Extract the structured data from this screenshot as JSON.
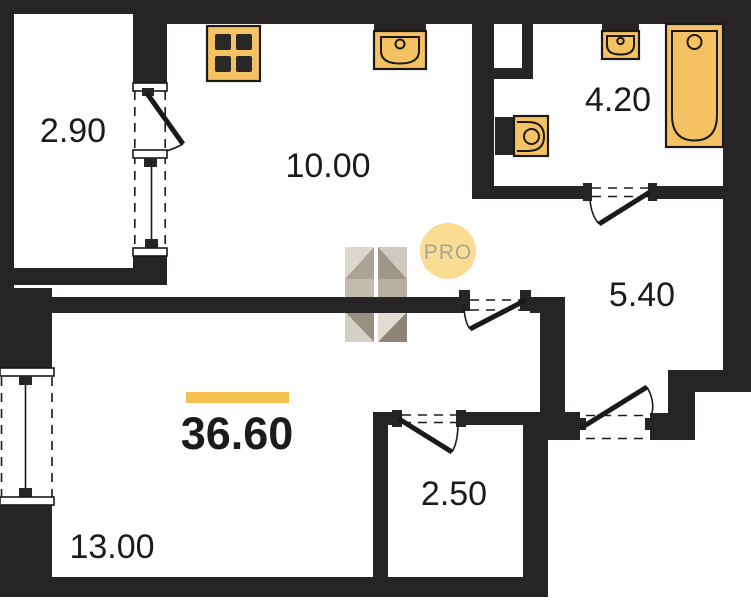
{
  "floor_plan": {
    "type": "apartment-floor-plan",
    "total_area": "36.60",
    "rooms": {
      "balcony": {
        "area": "2.90"
      },
      "kitchen": {
        "area": "10.00"
      },
      "bathroom": {
        "area": "4.20"
      },
      "hallway": {
        "area": "5.40"
      },
      "storage": {
        "area": "2.50"
      },
      "living_room": {
        "area": "13.00"
      }
    },
    "fixtures": [
      "stove-icon",
      "kitchen-sink-icon",
      "washbasin-icon",
      "toilet-icon",
      "bathtub-icon"
    ],
    "watermark": {
      "badge_text": "PRO"
    },
    "colors": {
      "wall": "#262424",
      "fixture": "#f5c263",
      "outline": "#1c1a19",
      "accent_bar": "#f5c24f",
      "badge_bg": "#fadd92",
      "badge_text": "#a8a59c",
      "label": "#1d1b1a"
    }
  }
}
